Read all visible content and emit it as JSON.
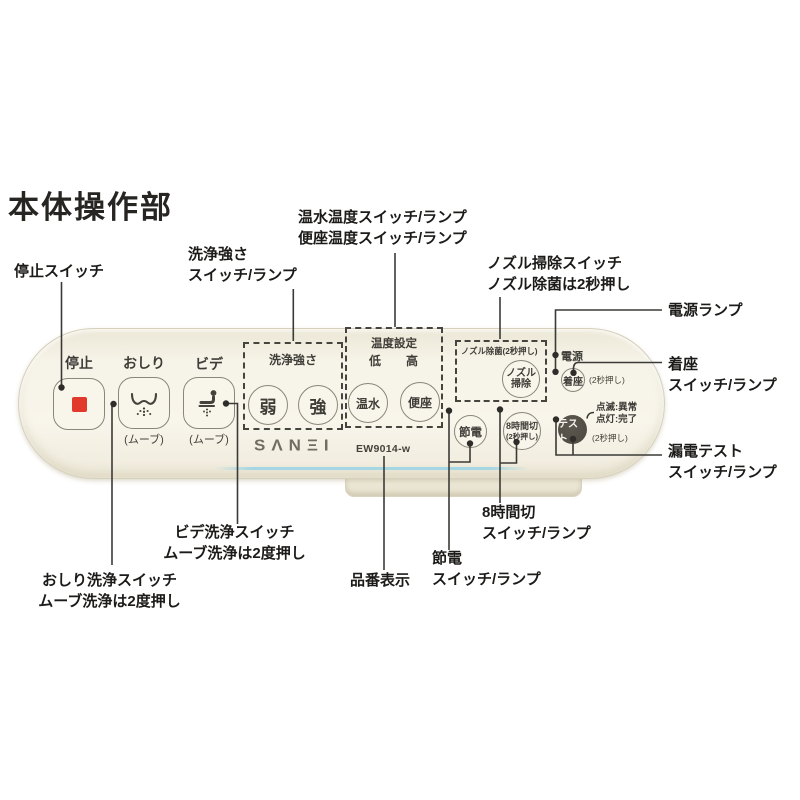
{
  "title": "本体操作部",
  "brand": {
    "logo": "SΛNΞI",
    "model": "EW9014-w"
  },
  "colors": {
    "panel_cream": "#f6f3e8",
    "accent_red": "#e13a2d",
    "test_button_dark": "#4c4840",
    "blue_accent_line": "#a5d6e4",
    "leader_line": "#3b3a36"
  },
  "panel": {
    "stop": {
      "label": "停止"
    },
    "oshiri": {
      "label": "おしり",
      "move": "(ムーブ)"
    },
    "bidet": {
      "label": "ビデ",
      "move": "(ムーブ)"
    },
    "strength": {
      "title": "洗浄強さ",
      "weak": "弱",
      "strong": "強"
    },
    "temp": {
      "title": "温度設定",
      "low": "低",
      "high": "高",
      "water": "温水",
      "seat": "便座"
    },
    "nozzle": {
      "title": "ノズル除菌(2秒押し)",
      "line1": "ノズル",
      "line2": "掃除"
    },
    "power": {
      "label": "電源"
    },
    "seating": {
      "label": "着座",
      "note": "(2秒押し)"
    },
    "test": {
      "label": "テスト",
      "note": "(2秒押し)",
      "blink": "点滅:異常",
      "lit": "点灯:完了"
    },
    "save": {
      "label": "節電"
    },
    "timer": {
      "label": "8時間切",
      "note": "(2秒押し)"
    }
  },
  "callouts": {
    "stop": "停止スイッチ",
    "strength": [
      "洗浄強さ",
      "スイッチ/ランプ"
    ],
    "temp": [
      "温水温度スイッチ/ランプ",
      "便座温度スイッチ/ランプ"
    ],
    "nozzle": [
      "ノズル掃除スイッチ",
      "ノズル除菌は2秒押し"
    ],
    "power_lamp": "電源ランプ",
    "seating": [
      "着座",
      "スイッチ/ランプ"
    ],
    "leak_test": [
      "漏電テスト",
      "スイッチ/ランプ"
    ],
    "timer": [
      "8時間切",
      "スイッチ/ランプ"
    ],
    "save": [
      "節電",
      "スイッチ/ランプ"
    ],
    "model": "品番表示",
    "bidet": [
      "ビデ洗浄スイッチ",
      "ムーブ洗浄は2度押し"
    ],
    "oshiri": [
      "おしり洗浄スイッチ",
      "ムーブ洗浄は2度押し"
    ]
  }
}
